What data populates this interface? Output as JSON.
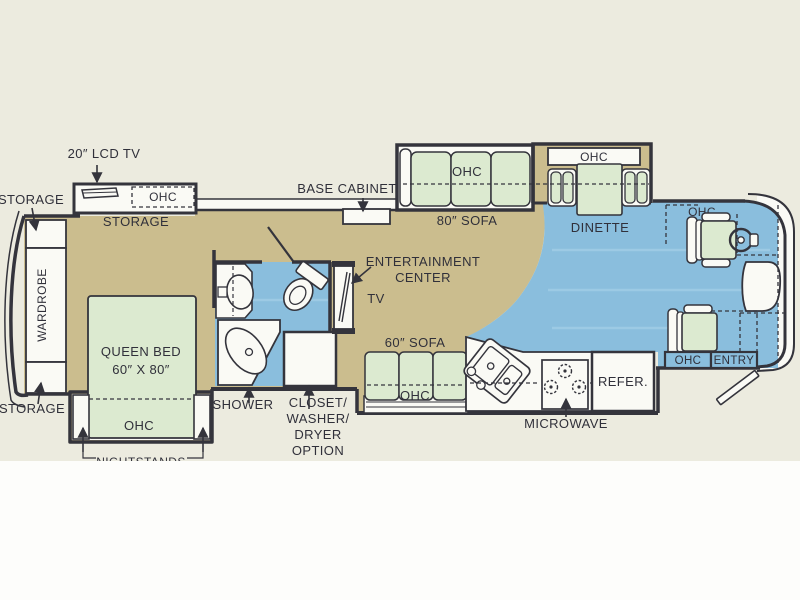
{
  "floorplan": {
    "labels": {
      "lcd_tv": "20″ LCD TV",
      "storage": "STORAGE",
      "ohc": "OHC",
      "wardrobe": "WARDROBE",
      "queen_bed": [
        "QUEEN BED",
        "60″ X 80″"
      ],
      "nightstands": "NIGHTSTANDS",
      "shower": "SHOWER",
      "closet": [
        "CLOSET/",
        "WASHER/",
        "DRYER",
        "OPTION"
      ],
      "base_cabinet": "BASE CABINET",
      "entertainment_center": [
        "ENTERTAINMENT",
        "CENTER"
      ],
      "tv": "TV",
      "sofa_80": "80″ SOFA",
      "dinette": "DINETTE",
      "sofa_60": "60″ SOFA",
      "microwave": "MICROWAVE",
      "refrigerator": "REFER.",
      "entry": "ENTRY"
    },
    "colors": {
      "background": "#ecebdf",
      "floor_tan": "#cbbd8e",
      "floor_blue": "#8abedd",
      "furniture_green": "#dcead0",
      "wall": "#34343c",
      "ink": "#30303a",
      "white": "#fafaf5",
      "page_white": "#fdfdfb"
    }
  }
}
